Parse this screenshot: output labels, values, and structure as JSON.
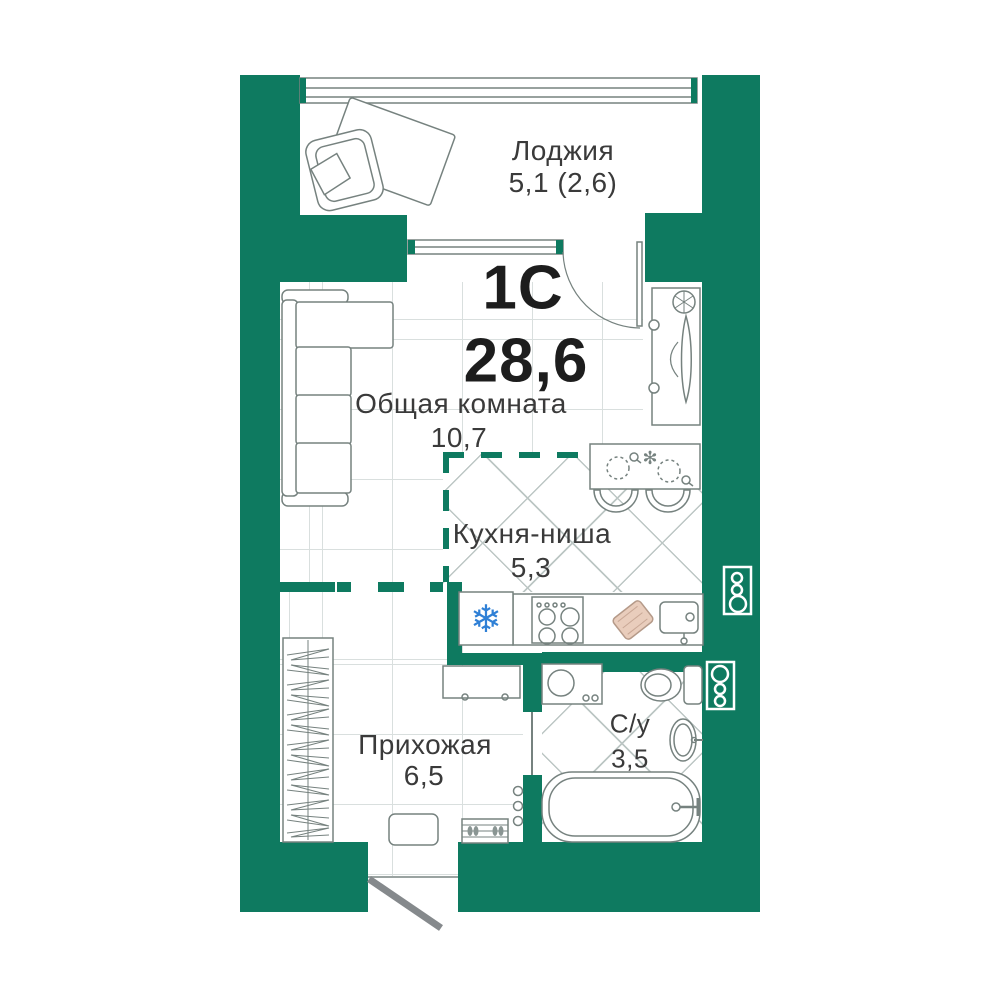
{
  "unit": {
    "type_label": "1С",
    "total_area": "28,6"
  },
  "rooms": {
    "loggia": {
      "name": "Лоджия",
      "area": "5,1 (2,6)"
    },
    "living": {
      "name": "Общая комната",
      "area": "10,7"
    },
    "kitchen": {
      "name": "Кухня-ниша",
      "area": "5,3"
    },
    "hallway": {
      "name": "Прихожая",
      "area": "6,5"
    },
    "bathroom": {
      "name": "С/у",
      "area": "3,5"
    }
  },
  "colors": {
    "wall": "#0e7a60",
    "furniture_line": "#76827f",
    "fridge_icon": "#2f80d6",
    "cutting_board": "#e9cdbc",
    "entrance_door": "#85898c",
    "label_text": "#3a3a3a",
    "number_text": "#1d1d1d"
  }
}
